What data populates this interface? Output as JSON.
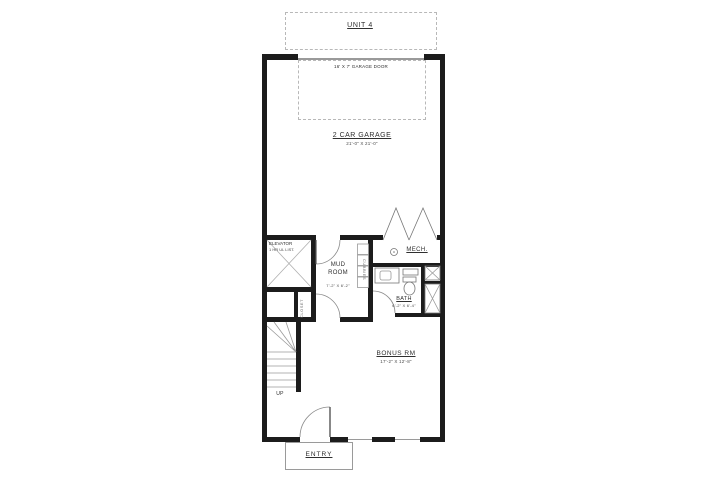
{
  "plan": {
    "unit": {
      "label": "UNIT 4"
    },
    "garage_door": {
      "label": "16' X 7' GARAGE DOOR"
    },
    "garage": {
      "label": "2 CAR GARAGE",
      "dims": "21'-0\" X 21'-0\""
    },
    "elevator": {
      "label": "ELEVATOR",
      "note": "1 HR UL LIST."
    },
    "mud_room": {
      "label": "MUD ROOM",
      "dims": "7'-2\" X 6'-2\""
    },
    "mech": {
      "label": "MECH."
    },
    "cubbies": {
      "label": "CUBBIES"
    },
    "closet": {
      "label": "CLOSET"
    },
    "bath": {
      "label": "BATH",
      "dims": "6'-2\" X 6'-4\""
    },
    "bonus_room": {
      "label": "BONUS RM",
      "dims": "17'-2\" X 12'-8\""
    },
    "stairs": {
      "label": "UP"
    },
    "entry": {
      "label": "ENTRY"
    },
    "colors": {
      "wall": "#1c1c1c",
      "linework": "#8a8a8a",
      "dashed": "#b8b8b8",
      "text": "#2f2f2f"
    }
  }
}
